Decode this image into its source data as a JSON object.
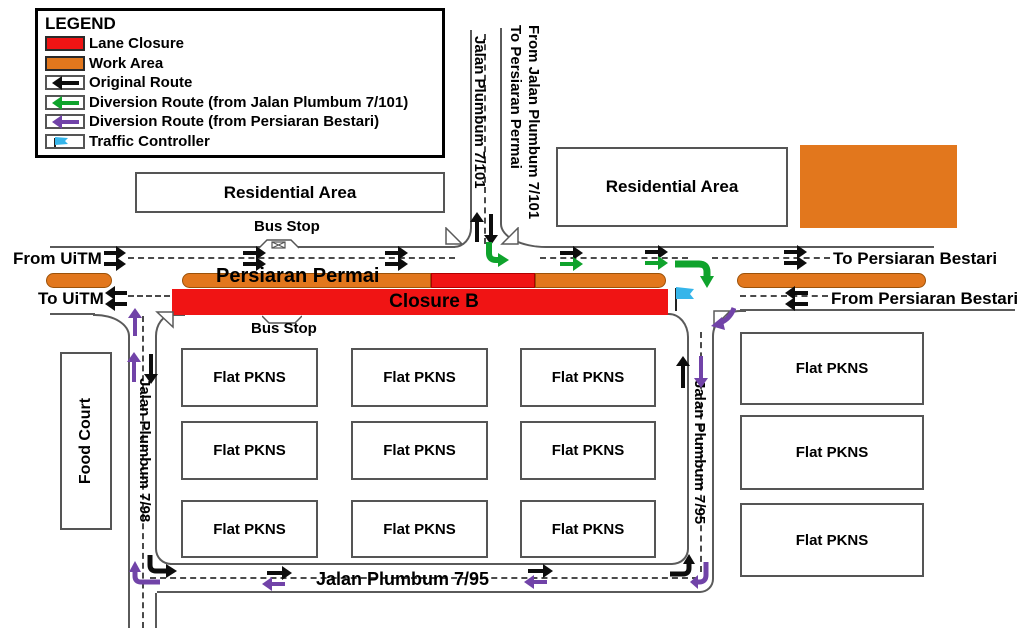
{
  "legend": {
    "title": "LEGEND",
    "items": [
      {
        "label": "Lane Closure"
      },
      {
        "label": "Work Area"
      },
      {
        "label": "Original Route"
      },
      {
        "label": "Diversion Route (from Jalan Plumbum 7/101)"
      },
      {
        "label": "Diversion Route (from Persiaran Bestari)"
      },
      {
        "label": "Traffic Controller"
      }
    ]
  },
  "labels": {
    "from_uitm": "From UiTM",
    "to_uitm": "To UiTM",
    "to_bestari": "To Persiaran Bestari",
    "from_bestari": "From Persiaran Bestari",
    "bus_stop": "Bus Stop"
  },
  "roads": {
    "persiaran_permai": "Persiaran Permai",
    "closure_b": "Closure B",
    "jp7_101": "Jalan Plumbum 7/101",
    "jp7_98": "Jalan Plumbum 7/98",
    "jp7_95": "Jalan Plumbum 7/95",
    "junction_note_line1": "From Jalan Plumbum 7/101",
    "junction_note_line2": "To Persiaran Permai"
  },
  "areas": {
    "residential": "Residential Area",
    "food_court": "Food Court",
    "flat_pkns": "Flat PKNS"
  },
  "colors": {
    "lane_closure": "#f01414",
    "work_area": "#e2771d",
    "original_route": "#0d0d0d",
    "diversion_from_jp7_101": "#0fa32c",
    "diversion_from_bestari": "#7143a8",
    "traffic_controller": "#35b5ea"
  }
}
